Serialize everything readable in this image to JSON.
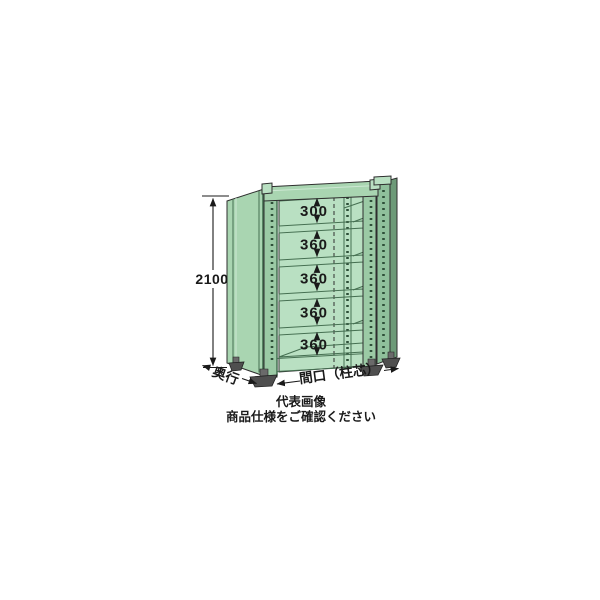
{
  "dimensions": {
    "overall_height": "2100",
    "gaps": [
      "300",
      "360",
      "360",
      "360",
      "360"
    ],
    "depth_label": "奥行",
    "width_label": "間口（柱芯）"
  },
  "caption": {
    "line1": "代表画像",
    "line2": "商品仕様をご確認ください"
  },
  "colors": {
    "background": "#ffffff",
    "rack_light": "#a9d5b1",
    "rack_mid": "#9bcaa5",
    "rack_bay": "#b9e0c2",
    "rack_strip": "#8fc09b",
    "rack_panel_dark": "#6d9a78",
    "rack_line_dark": "#456f51",
    "hole": "#2e4f38",
    "outline": "#2e2e2e",
    "highlight": "#cde8d3",
    "foot": "#4f4f4f",
    "foot_light": "#6a6a6a",
    "dim": "#1a1a1a",
    "text": "#1a1a1a"
  }
}
